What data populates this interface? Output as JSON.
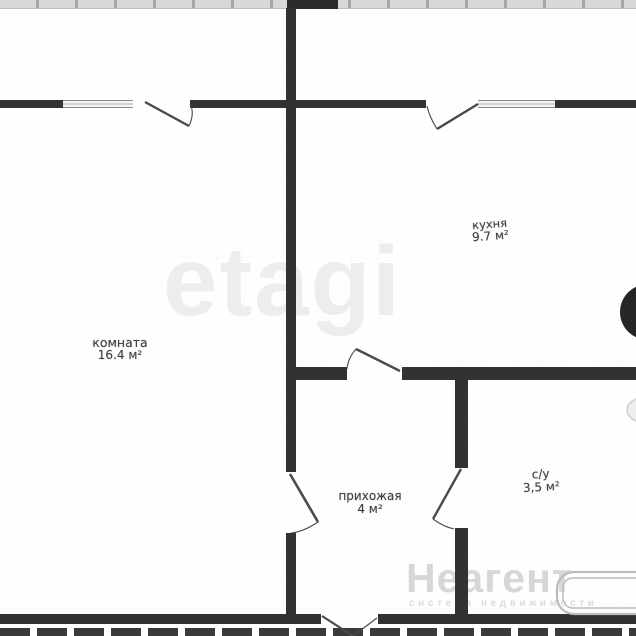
{
  "floorplan": {
    "rooms": [
      {
        "name": "комната",
        "area": "16.4 м²"
      },
      {
        "name": "кухня",
        "area": "9.7 м²"
      },
      {
        "name": "прихожая",
        "area": "4 м²"
      },
      {
        "name": "с/у",
        "area": "3,5 м²"
      }
    ],
    "watermarks": {
      "center": "etagi",
      "brand": "Неагент",
      "brand_tagline": "система недвижимости"
    },
    "colors": {
      "wall": "#323232",
      "window_frame": "#8f8f8f",
      "watermark_light": "#ededed",
      "background": "#fefefe"
    }
  }
}
